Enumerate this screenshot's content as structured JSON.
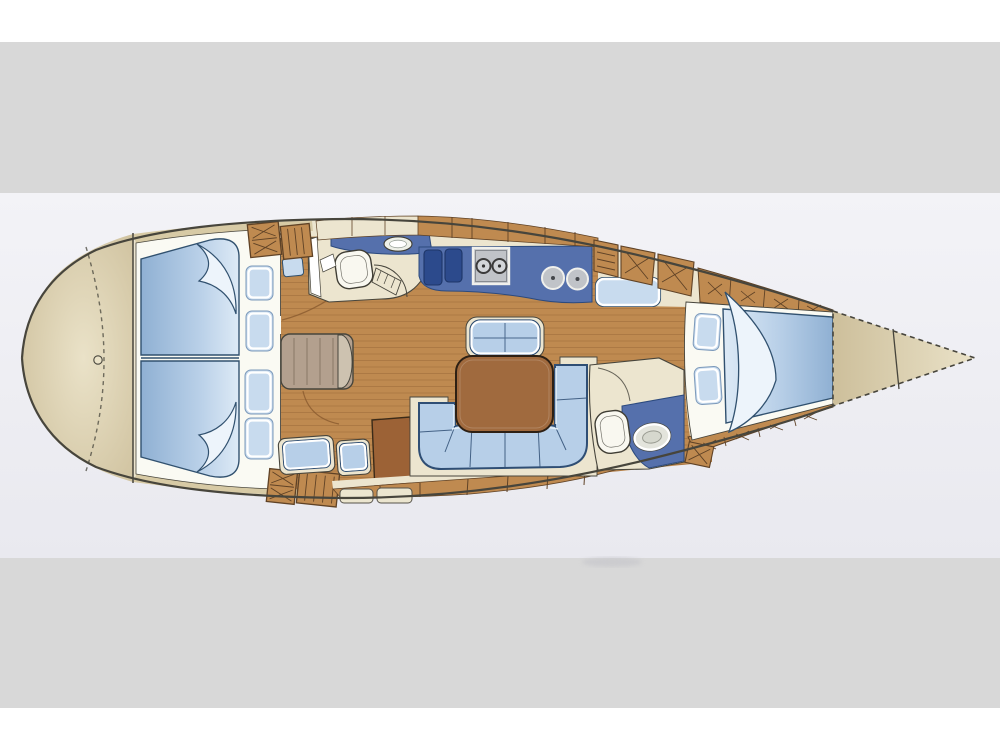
{
  "figure": {
    "kind": "sailboat-interior-floor-plan",
    "orientation": "bow-right",
    "visible_text": ""
  },
  "colors": {
    "page_bg": "#ffffff",
    "band_gray": "#d8d8d8",
    "photo_bg": "#f3f3f7",
    "photo_bg2": "#e9e9ef",
    "outline": "#47453c",
    "deck": "#cdbf9b",
    "deck_light": "#eae2c8",
    "deck_band": "#d7caa5",
    "cream": "#ece5cf",
    "frame": "#fafaf3",
    "wood": "#bf8a50",
    "wood_line": "#8a5a2e",
    "locker_edge": "#5f4226",
    "berth_dark": "#8fb0d3",
    "berth_mid": "#b9d0e8",
    "berth_light": "#ddeaf6",
    "berth_hi": "#edf4fb",
    "berth_outline": "#31516f",
    "pillow": "#c8dbee",
    "pillow_edge": "#7c99ba",
    "counter": "#5570ac",
    "counter_dark": "#2c4a7e",
    "sink_dark": "#2c4a8c",
    "settee": "#b7cfe8",
    "settee_outline": "#2f4e74",
    "table": "#a06a3e",
    "table_edge": "#2d2014",
    "cabinet": "#9c6236",
    "chair": "#b3a08e",
    "chair_cap": "#cdc2b0",
    "fixture": "#f9f8f0",
    "fixture_edge": "#3f3d34",
    "stove": "#c0c3c8",
    "stove_edge": "#f0f0ec",
    "burner": "#3b3b3b",
    "shadow": "#c2c2c8"
  },
  "areas": [
    {
      "name": "stern-deck"
    },
    {
      "name": "aft-cabin-port-berth"
    },
    {
      "name": "aft-cabin-starboard-berth"
    },
    {
      "name": "aft-head"
    },
    {
      "name": "nav-seat"
    },
    {
      "name": "nav-cabinet"
    },
    {
      "name": "galley"
    },
    {
      "name": "salon-table"
    },
    {
      "name": "salon-settee"
    },
    {
      "name": "salon-forward-seat"
    },
    {
      "name": "forward-head"
    },
    {
      "name": "forward-cabin-berth"
    },
    {
      "name": "foredeck-anchor-locker"
    }
  ],
  "counts": {
    "pillows": 6,
    "galley_sinks": 2,
    "stove_burners": 2,
    "round_plates": 2,
    "steps": 2,
    "toilets": 2,
    "wash_basins": 3
  }
}
